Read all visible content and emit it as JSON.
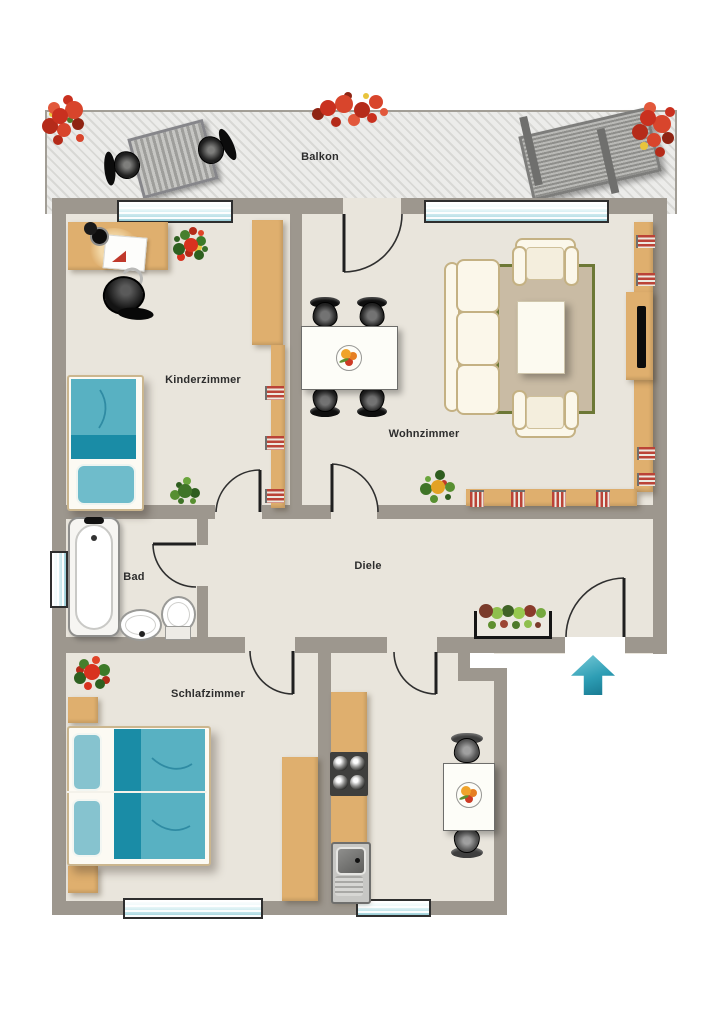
{
  "rooms": {
    "balkon": {
      "label": "Balkon"
    },
    "kinderzimmer": {
      "label": "Kinderzimmer"
    },
    "wohnzimmer": {
      "label": "Wohnzimmer"
    },
    "bad": {
      "label": "Bad"
    },
    "diele": {
      "label": "Diele"
    },
    "schlafzimmer": {
      "label": "Schlafzimmer"
    }
  },
  "colors": {
    "wall": "#9d978e",
    "floor": "#e9e5dc",
    "wood": "#dfaf6e",
    "teal_dark": "#1a8ca6",
    "teal_mid": "#58b1c2",
    "teal_light": "#86c3cf",
    "sofa_cream": "#fbf7ea",
    "rug": "#c9bba4",
    "rug_border": "#6d7836",
    "window_glass": "#b9e0e7",
    "book_red": "#bb4337",
    "arrow_teal": "#2d9db4"
  },
  "furniture": {
    "balkon": [
      "patio-table",
      "patio-chair",
      "patio-chair",
      "sun-lounger",
      "flower-box",
      "flower-box",
      "flower-box"
    ],
    "kinderzimmer": [
      "desk",
      "desk-chair",
      "single-bed",
      "wall-shelf",
      "books",
      "poinsettia-plant",
      "green-plant"
    ],
    "wohnzimmer": [
      "dining-table",
      "dining-chair",
      "dining-chair",
      "dining-chair",
      "dining-chair",
      "fruit-bowl",
      "sofa",
      "armchair",
      "armchair",
      "coffee-table",
      "rug",
      "tv-board",
      "tv",
      "wall-shelf",
      "books",
      "green-plant"
    ],
    "bad": [
      "bathtub",
      "wash-basin",
      "toilet"
    ],
    "diele": [
      "plant-box"
    ],
    "schlafzimmer": [
      "double-bed",
      "nightstand",
      "nightstand",
      "wardrobe",
      "poinsettia-plant"
    ],
    "kitchen": [
      "kitchen-counter",
      "stove",
      "kitchen-sink",
      "kitchen-table",
      "kitchen-chair",
      "kitchen-chair",
      "fruit-bowl"
    ],
    "entrance": [
      "entrance-arrow"
    ]
  }
}
